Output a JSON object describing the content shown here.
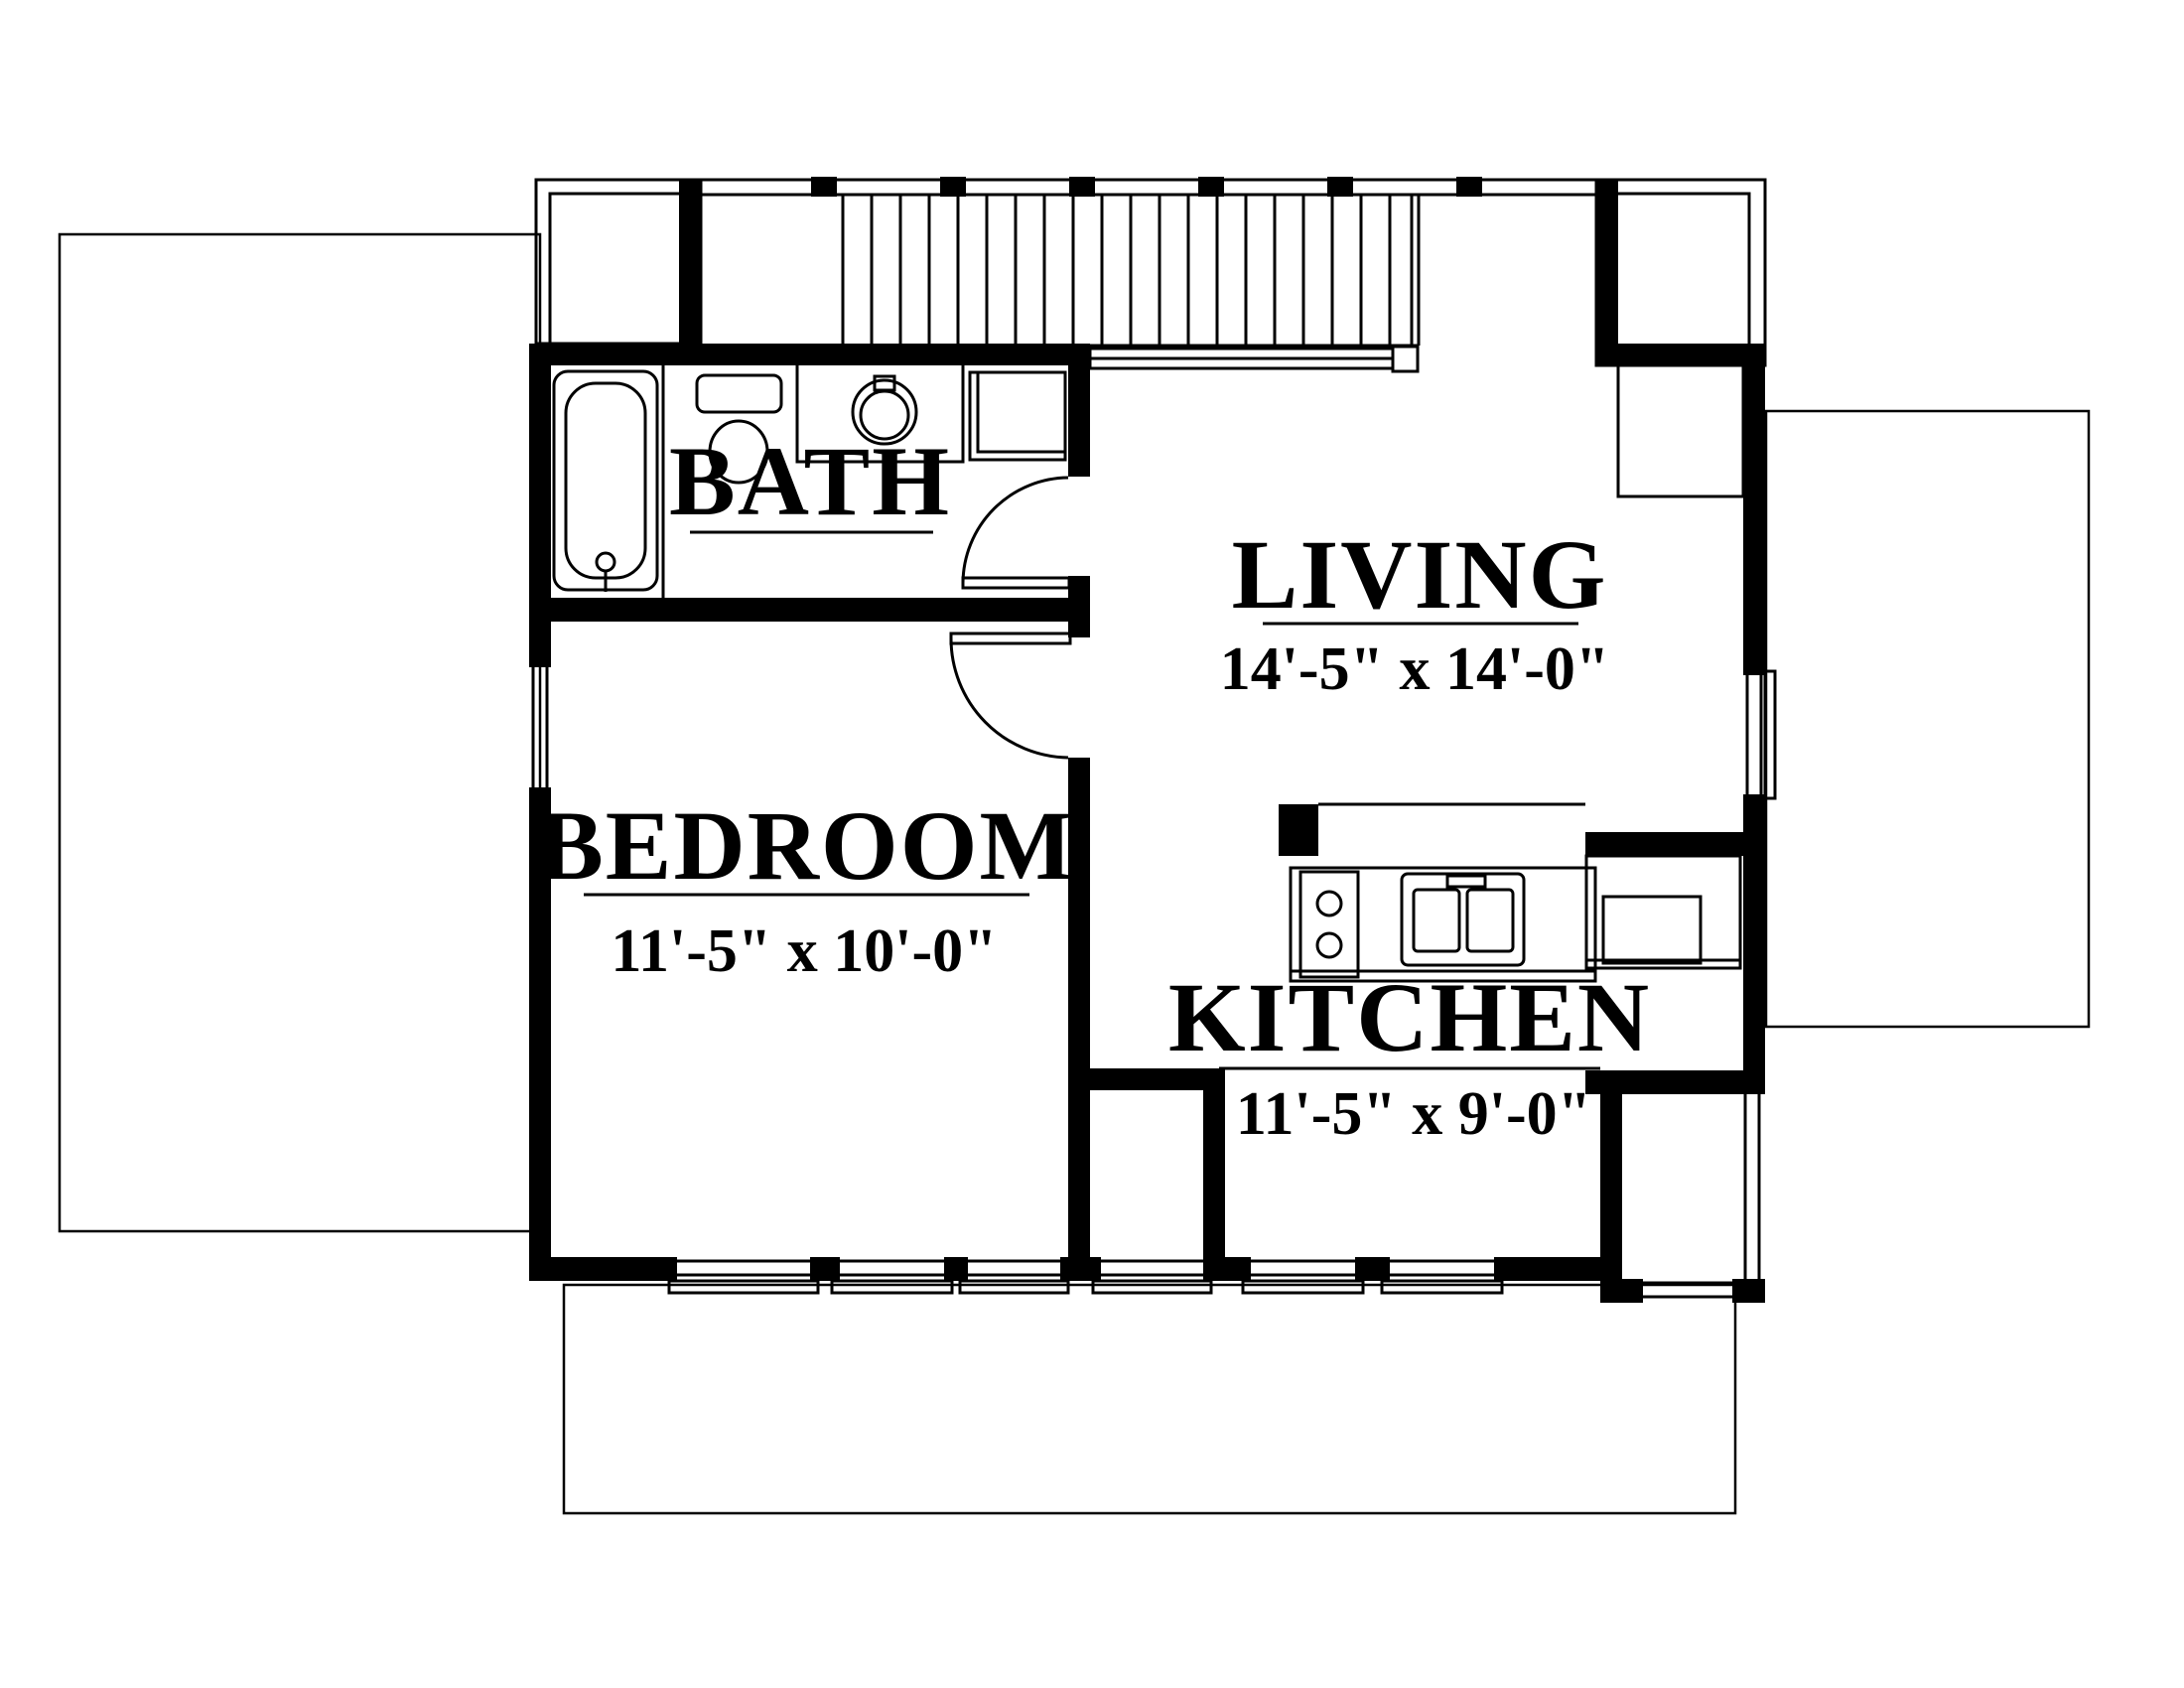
{
  "page": {
    "type": "architectural-floor-plan",
    "background_color": "#ffffff",
    "line_color": "#000000"
  },
  "rooms": {
    "bath": {
      "label": "BATH"
    },
    "living": {
      "label": "LIVING",
      "dimensions": "14'-5\" x 14'-0\""
    },
    "bedroom": {
      "label": "BEDROOM",
      "dimensions": "11'-5\" x 10'-0\""
    },
    "kitchen": {
      "label": "KITCHEN",
      "dimensions": "11'-5\" x 9'-0\""
    }
  },
  "fixtures": {
    "bath": [
      "bathtub",
      "vanity-sink",
      "toilet",
      "round-sink",
      "linen-cabinet"
    ],
    "kitchen": [
      "range",
      "double-sink",
      "refrigerator-counter"
    ],
    "circulation": [
      "staircase",
      "stair-railing",
      "bath-door",
      "bedroom-door"
    ],
    "exterior": [
      "left-roof-outline",
      "right-roof-outline",
      "bottom-roof-outline",
      "left-dormer",
      "right-dormer"
    ]
  }
}
